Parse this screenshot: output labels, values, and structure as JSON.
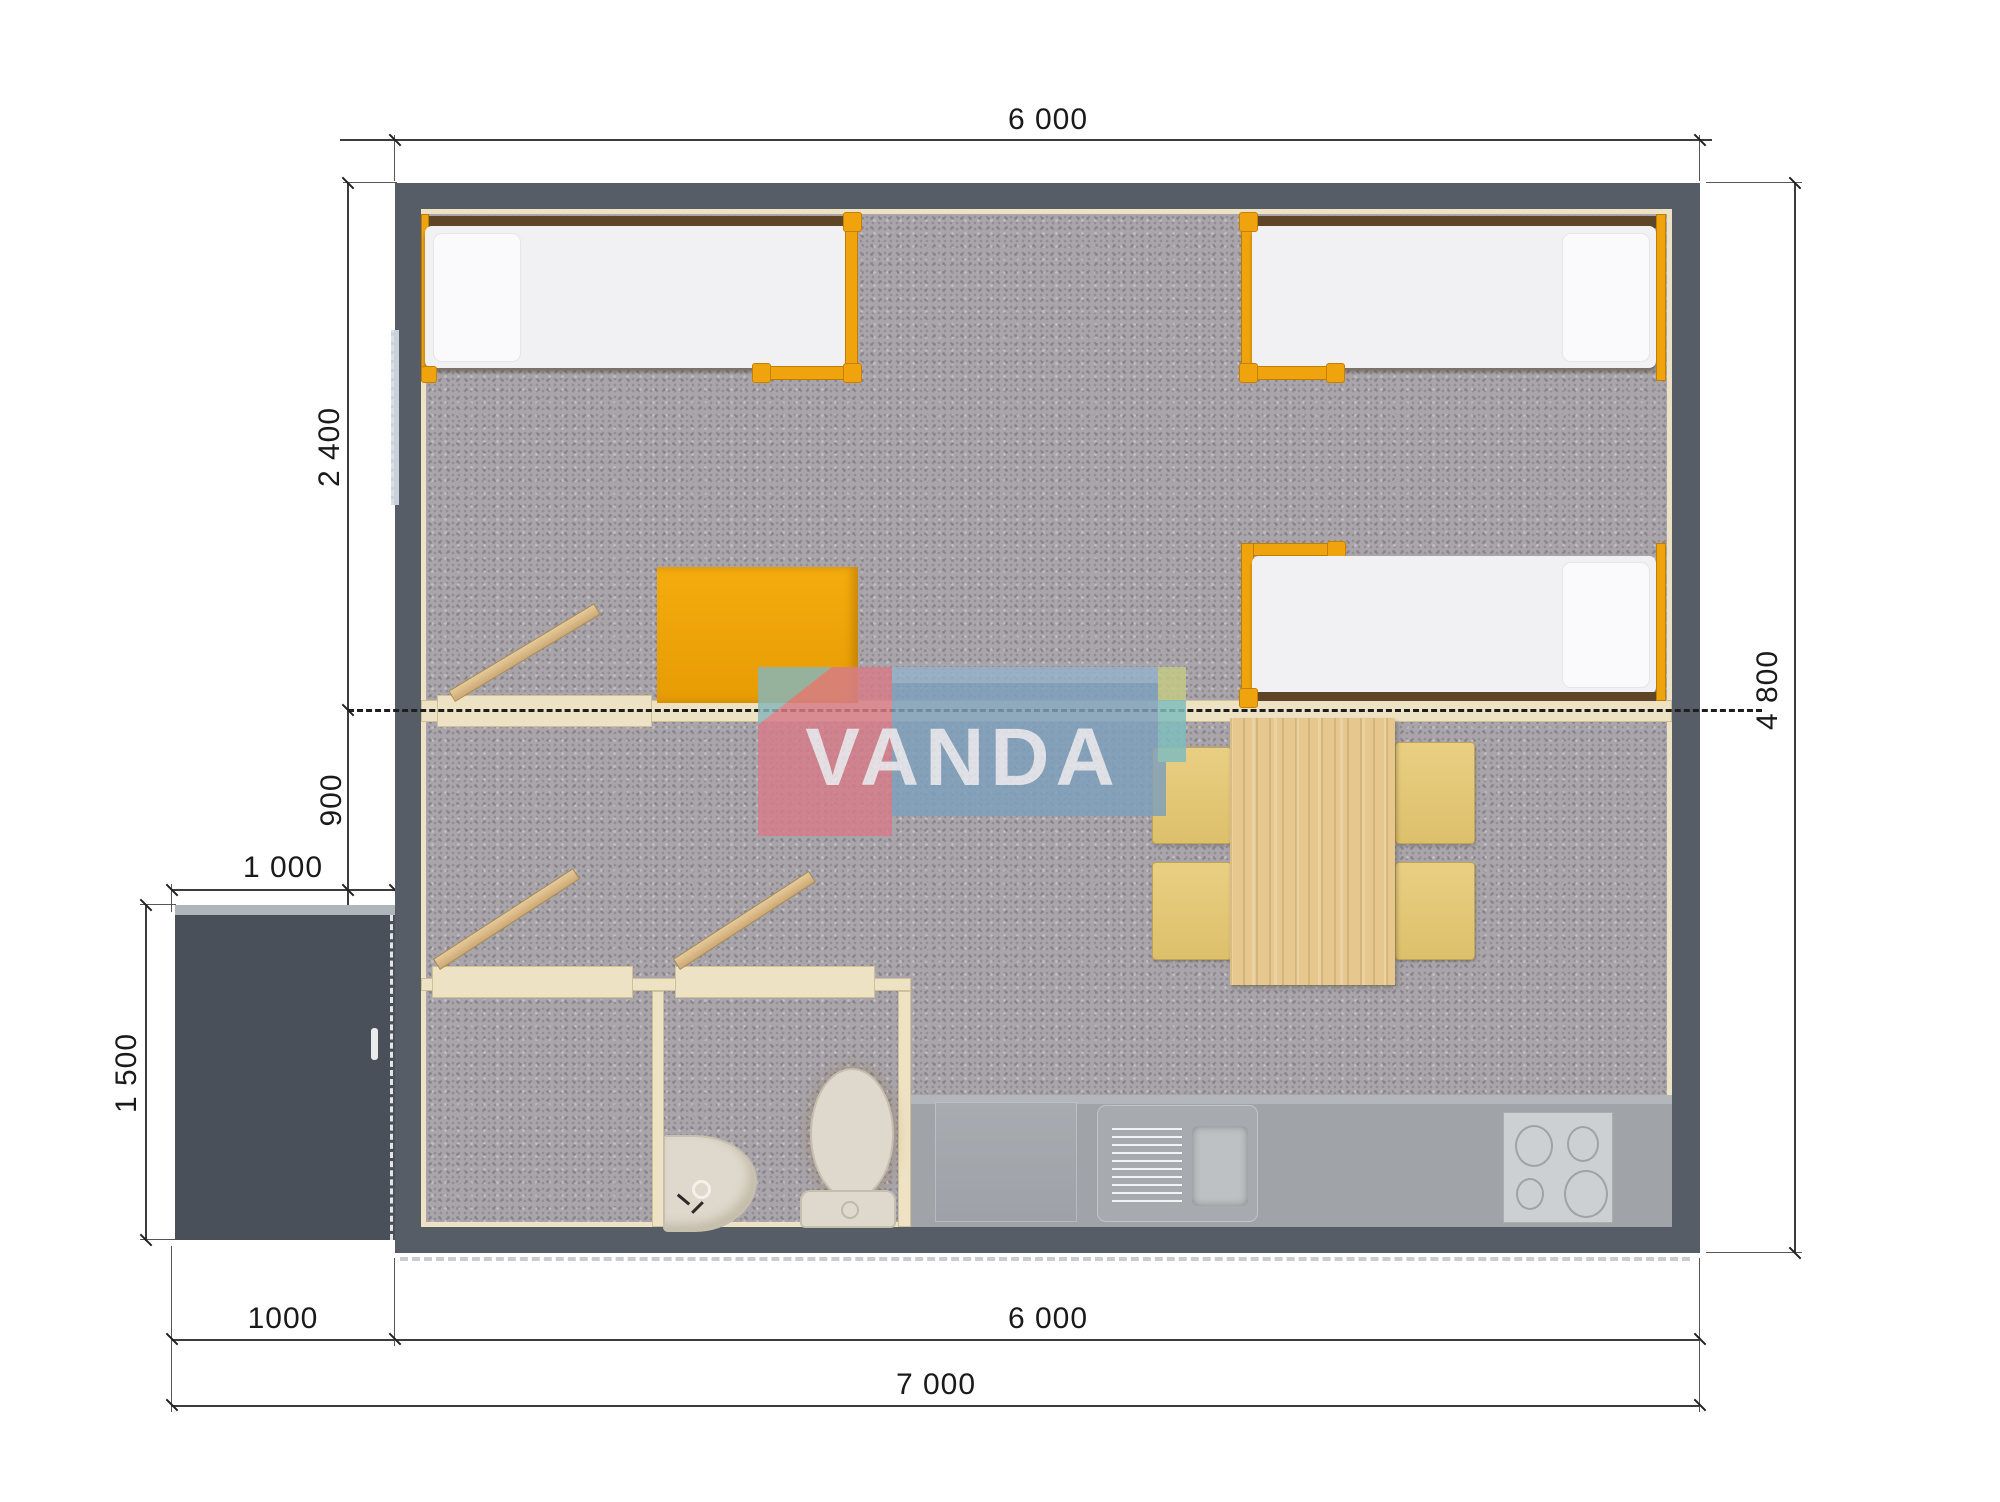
{
  "document": {
    "type": "floor-plan render, top view",
    "brand_watermark": "VANDA"
  },
  "watermark": {
    "text": "VANDA"
  },
  "dimensions": {
    "top_width": "6 000",
    "right_height": "4 800",
    "bedroom_depth": "2 400",
    "hall_depth": "900",
    "porch_width_top": "1 000",
    "porch_depth": "1 500",
    "bottom_porch_width": "1000",
    "bottom_body_width": "6 000",
    "bottom_total_width": "7 000"
  },
  "furniture_inventory": {
    "single_beds": 3,
    "wardrobe": 1,
    "dining_table": 1,
    "chairs": 4,
    "toilet": 1,
    "washbasin": 1,
    "kitchen_sink_unit": 1,
    "kitchen_cabinet": 1,
    "stove_burners": 4,
    "open_doors": 3,
    "porch": 1
  },
  "colors": {
    "wall": "#575D66",
    "porch": "#4A505A",
    "carpet": "#A9A5AA",
    "kitchenFloor": "#A0A4A9",
    "cream": "#EDE2C3",
    "orange": "#EFA30D",
    "bedWhite": "#F1F1F4",
    "pine": "#E6C88F",
    "fixture": "#DED9CC",
    "stove": "#CDD0D2",
    "window": "#C9D2DA",
    "logoPink": "#D67D8A",
    "logoBlue": "#7FA0BC",
    "logoTeal": "#7FBDBE"
  }
}
